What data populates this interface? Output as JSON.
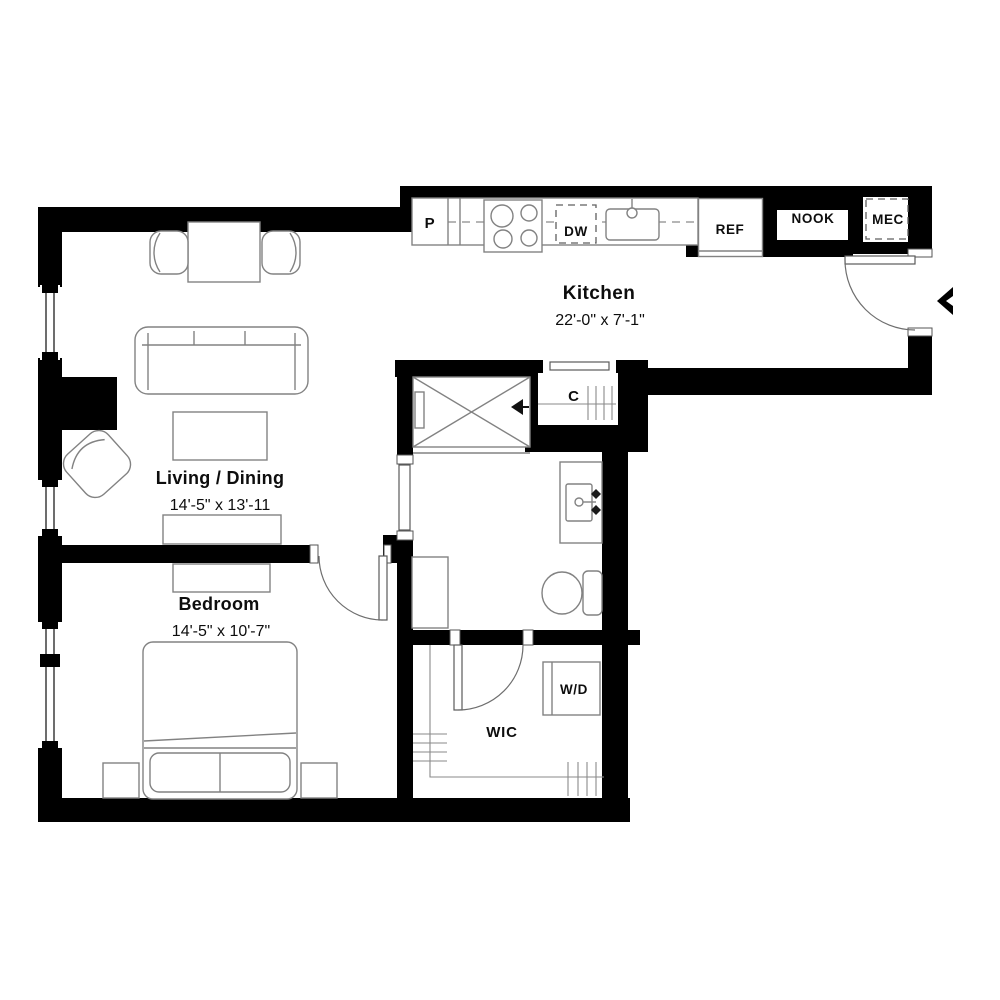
{
  "colors": {
    "wall": "#000000",
    "background": "#ffffff",
    "furniture_line": "#828282",
    "text": "#0d0d0d"
  },
  "rooms": {
    "kitchen": {
      "name": "Kitchen",
      "dims": "22'-0\" x 7'-1\""
    },
    "living": {
      "name": "Living / Dining",
      "dims": "14'-5\" x 13'-11"
    },
    "bedroom": {
      "name": "Bedroom",
      "dims": "14'-5\" x 10'-7\""
    },
    "wic": {
      "name": "WIC"
    }
  },
  "fixtures": {
    "pantry": "P",
    "dishwasher": "DW",
    "refrigerator": "REF",
    "nook": "NOOK",
    "mechanical": "MEC",
    "coat_closet": "C",
    "washer_dryer": "W/D"
  }
}
